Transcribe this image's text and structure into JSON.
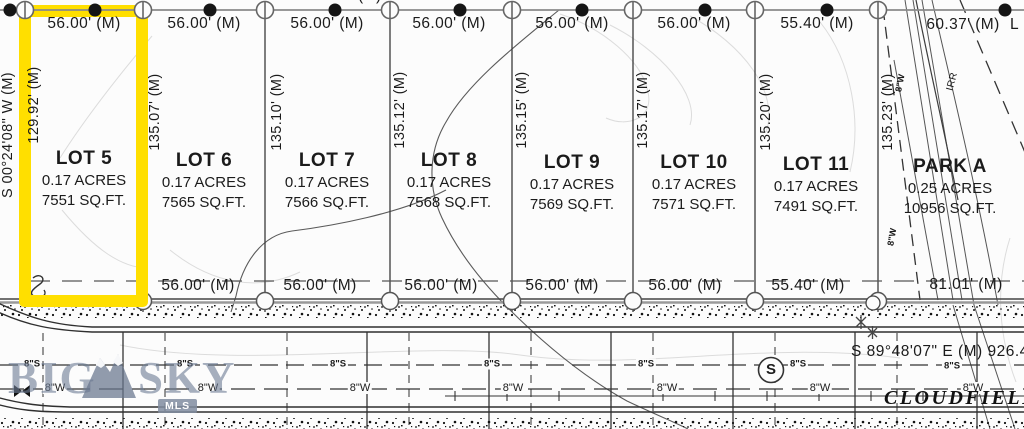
{
  "map": {
    "top_clipped_bearing": "S 89°48'48\" E (M)  391.10'",
    "right_clipped_text": "L",
    "left_bearing": "S 00°24'08\" W (M)",
    "bottom_bearing": "S 89°48'07\" E (M)  926.45'",
    "street_name": "CLOUDFIELD",
    "top_dims": [
      "56.00' (M)",
      "56.00' (M)",
      "56.00' (M)",
      "56.00' (M)",
      "56.00' (M)",
      "56.00' (M)",
      "55.40' (M)",
      "60.37' (M)"
    ],
    "side_dims": [
      "129.92' (M)",
      "135.07' (M)",
      "135.10' (M)",
      "135.12' (M)",
      "135.15' (M)",
      "135.17' (M)",
      "135.20' (M)",
      "135.23' (M)"
    ],
    "bottom_dims": [
      "56.00' (M)",
      "56.00' (M)",
      "56.00' (M)",
      "56.00' (M)",
      "56.00' (M)",
      "55.40' (M)",
      "81.01' (M)"
    ],
    "lots": [
      {
        "name": "LOT 5",
        "acres": "0.17 ACRES",
        "sqft": "7551 SQ.FT."
      },
      {
        "name": "LOT 6",
        "acres": "0.17 ACRES",
        "sqft": "7565 SQ.FT."
      },
      {
        "name": "LOT 7",
        "acres": "0.17 ACRES",
        "sqft": "7566 SQ.FT."
      },
      {
        "name": "LOT 8",
        "acres": "0.17 ACRES",
        "sqft": "7568 SQ.FT."
      },
      {
        "name": "LOT 9",
        "acres": "0.17 ACRES",
        "sqft": "7569 SQ.FT."
      },
      {
        "name": "LOT 10",
        "acres": "0.17 ACRES",
        "sqft": "7571 SQ.FT."
      },
      {
        "name": "LOT 11",
        "acres": "0.17 ACRES",
        "sqft": "7491 SQ.FT."
      },
      {
        "name": "PARK A",
        "acres": "0.25 ACRES",
        "sqft": "10956 SQ.FT."
      }
    ],
    "utilities": {
      "sewer_label": "8\"S",
      "water_label": "8\"W",
      "irrigation_label": "IRR",
      "manhole_label": "S"
    },
    "highlight_color": "#FFDF00"
  },
  "watermark": {
    "word1": "BIG",
    "word2": "SKY",
    "badge": "MLS"
  }
}
